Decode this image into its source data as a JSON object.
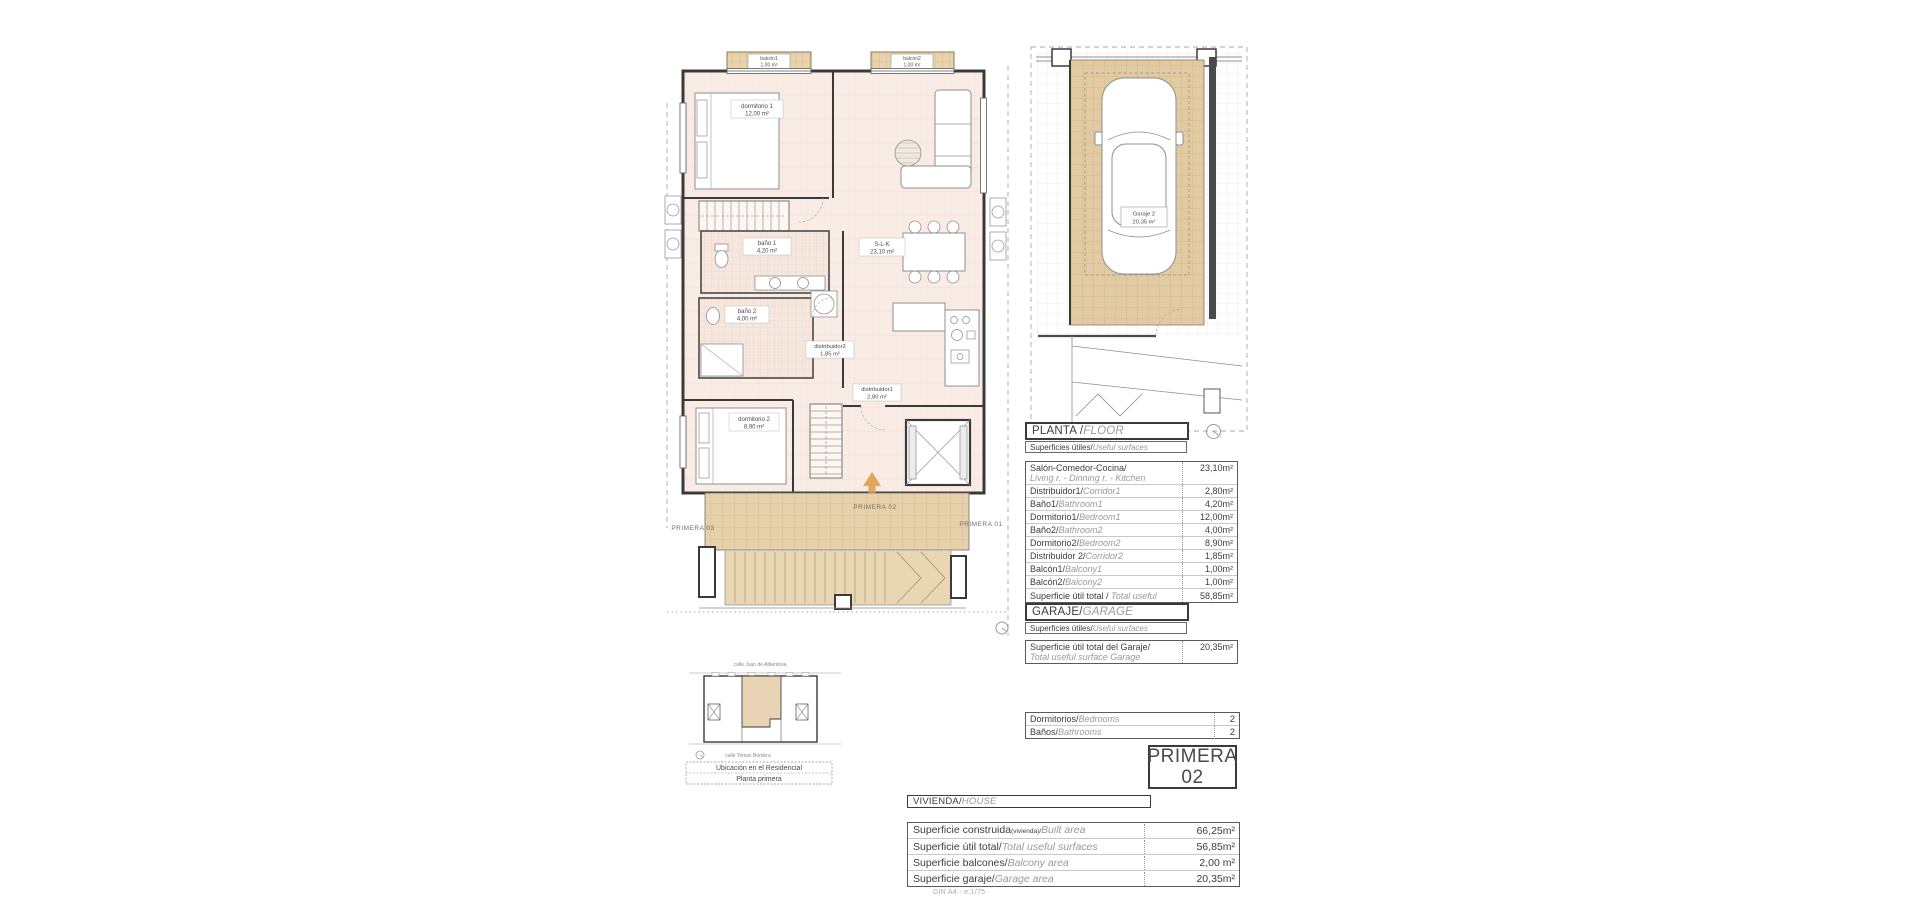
{
  "floor_plan": {
    "balcon1": {
      "name": "balcón1",
      "area": "1,00 m²"
    },
    "balcon2": {
      "name": "balcón2",
      "area": "1,00 m²"
    },
    "dormitorio1": {
      "name": "dormitorio 1",
      "area": "12,00 m²"
    },
    "bano1": {
      "name": "baño 1",
      "area": "4,20 m²"
    },
    "slk": {
      "name": "S-L-K",
      "area": "23,10 m²"
    },
    "bano2": {
      "name": "baño 2",
      "area": "4,00 m²"
    },
    "distribuidor2": {
      "name": "distribuidor2",
      "area": "1,85 m²"
    },
    "distribuidor1": {
      "name": "distribuidor1",
      "area": "2,80 m²"
    },
    "dormitorio2": {
      "name": "dormitorio 2",
      "area": "8,90 m²"
    },
    "corridor_center": "PRIMERA 02",
    "corridor_left": "PRIMERA 03",
    "corridor_right": "PRIMERA 01"
  },
  "garage_plan": {
    "name": "Garaje 2",
    "area": "20,35 m²"
  },
  "planta_table": {
    "title_es": "PLANTA / ",
    "title_en": "FLOOR",
    "subtitle_es": "Superficies útiles/",
    "subtitle_en": "Useful surfaces",
    "rows": [
      {
        "es": "Salón-Comedor-Cocina/",
        "en": "Living r. - Dinning r. - Kitchen",
        "value": "23,10m²"
      },
      {
        "es": "Distribuidor1/",
        "en": "Corridor1",
        "value": "2,80m²"
      },
      {
        "es": "Baño1/",
        "en": "Bathroom1",
        "value": "4,20m²"
      },
      {
        "es": "Dormitorio1/",
        "en": "Bedroom1",
        "value": "12,00m²"
      },
      {
        "es": "Baño2/",
        "en": "Bathroom2",
        "value": "4,00m²"
      },
      {
        "es": "Dormitorio2/",
        "en": "Bedroom2",
        "value": "8,90m²"
      },
      {
        "es": "Distribuidor 2/",
        "en": "Corridor2",
        "value": "1,85m²"
      },
      {
        "es": "Balcón1/",
        "en": "Balcony1",
        "value": "1,00m²"
      },
      {
        "es": "Balcón2/",
        "en": "Balcony2",
        "value": "1,00m²"
      },
      {
        "es": "Superficie útil total / ",
        "en": "Total useful surface",
        "value": "58,85m²"
      }
    ]
  },
  "garaje_table": {
    "title_es": "GARAJE/",
    "title_en": "GARAGE",
    "subtitle_es": "Superficies útiles/",
    "subtitle_en": "Useful surfaces",
    "row_es": "Superficie útil total del Garaje/",
    "row_en": "Total useful surface Garage",
    "row_value": "20,35m²"
  },
  "counts_table": {
    "rows": [
      {
        "es": "Dormitorios/",
        "en": "Bedrooms",
        "value": "2"
      },
      {
        "es": "Baños/",
        "en": "Bathrooms",
        "value": "2"
      }
    ]
  },
  "unit_badge": {
    "line1": "PRIMERA",
    "line2": "02"
  },
  "vivienda_table": {
    "title_es": "VIVIENDA/",
    "title_en": "HOUSE",
    "rows": [
      {
        "es": "Superficie construida",
        "note": "(vivienda)/",
        "en": "Built area",
        "value": "66,25m²"
      },
      {
        "es": "Superficie útil total/",
        "note": "",
        "en": "Total useful surfaces",
        "value": "56,85m²"
      },
      {
        "es": "Superficie balcones/",
        "note": "",
        "en": "Balcony area",
        "value": "2,00 m²"
      },
      {
        "es": "Superficie garaje/",
        "note": "",
        "en": "Garage area",
        "value": "20,35m²"
      }
    ]
  },
  "location_plan": {
    "street_top": "calle Juan de Albentosa",
    "street_bottom": "calle Tomás Bordera",
    "caption_line1": "Ubicación en el Residencial",
    "caption_line2": "Planta primera"
  },
  "footer_note": "DIN A4 - e:1/75"
}
